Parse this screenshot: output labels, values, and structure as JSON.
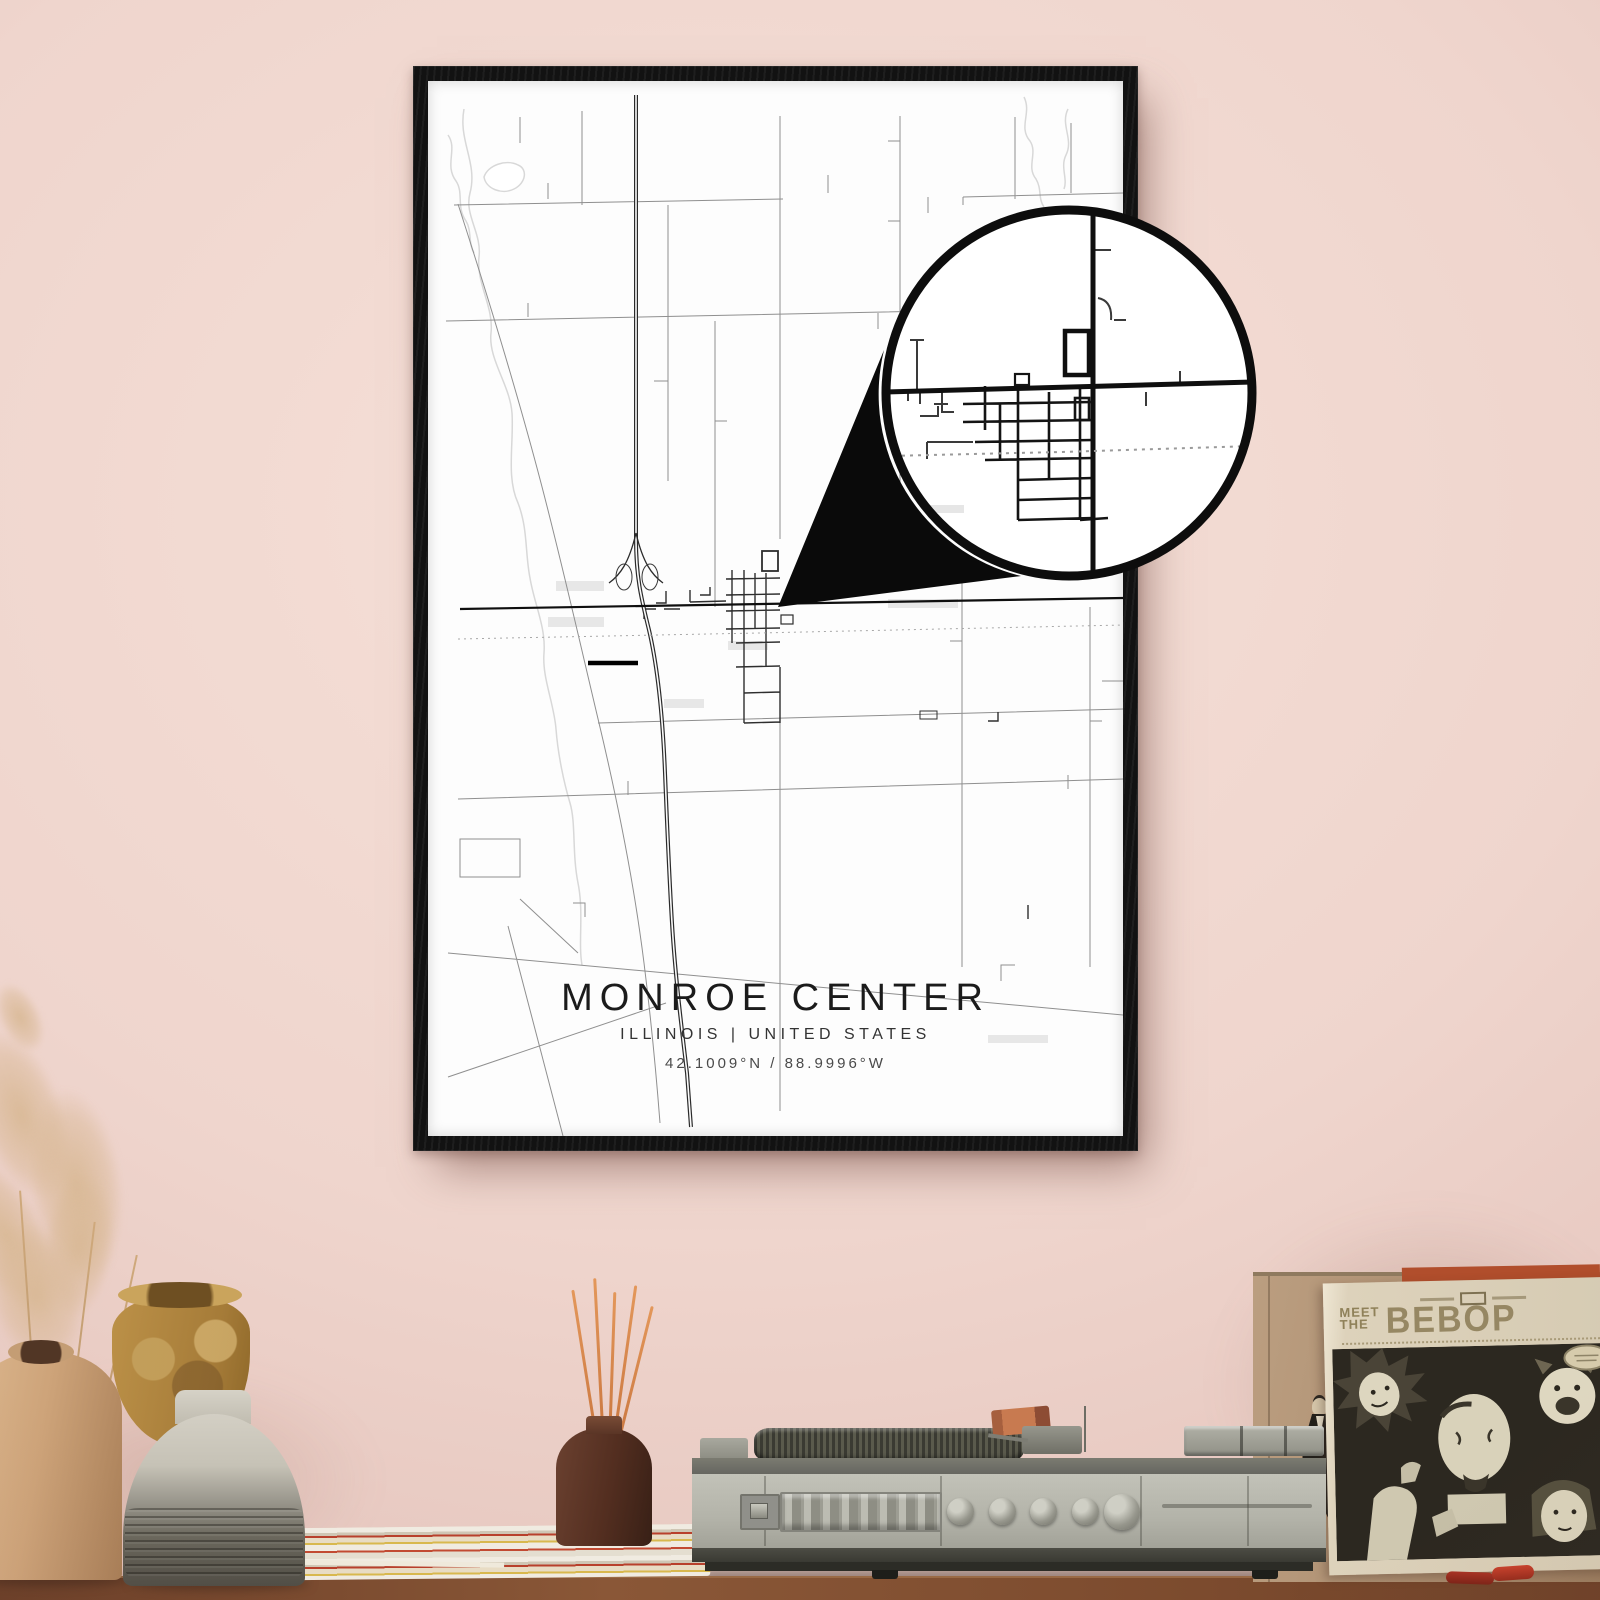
{
  "poster": {
    "title": "MONROE CENTER",
    "subtitle": "ILLINOIS | UNITED STATES",
    "coordinates": "42.1009°N / 88.9996°W",
    "frame_color": "#121212",
    "paper_color": "#fdfdfd",
    "road_color": "#303030",
    "water_color": "#d8d8d8"
  },
  "magnifier": {
    "ring_color": "#0d0d0d",
    "fill_color": "#ffffff"
  },
  "sleeve": {
    "pre1": "MEET",
    "pre2": "THE",
    "title": "BEBOP",
    "ink_color": "#8f8159",
    "bg_color": "#d8cdb6"
  },
  "scene": {
    "wall_color": "#efd5cd",
    "shelf_color": "#7c4a2e",
    "objects": [
      "pampas-grass",
      "tan-jug-vase",
      "ochre-vase",
      "gray-bottle-vase",
      "magazine-stack",
      "reed-diffuser",
      "record-player",
      "cardboard-box",
      "figurine",
      "record-sleeve",
      "red-lighters"
    ]
  }
}
